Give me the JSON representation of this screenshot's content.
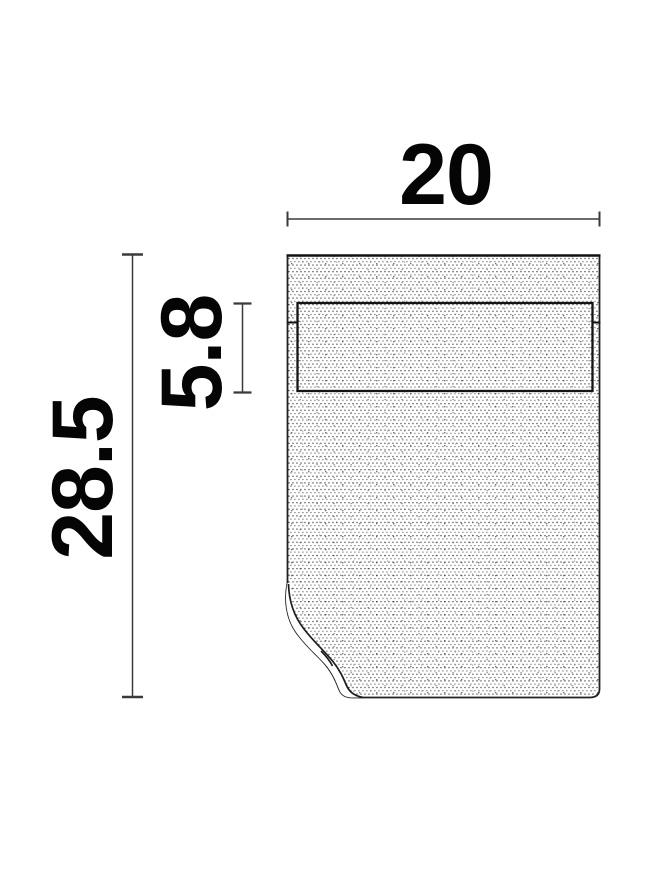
{
  "page": {
    "background": "#ffffff",
    "description": "Technical dimension drawing of a rectangular fabric shade with folded bottom-left corner"
  },
  "diagram": {
    "type": "product-dimension-drawing",
    "dimensions": {
      "width": "20",
      "height": "28.5",
      "inner_height": "5.8"
    },
    "colors": {
      "outline": "#1c1c1c",
      "inner_panel_line": "#141414",
      "dimension_line": "#3a3a3a",
      "label_text": "#050505",
      "stipple_dot": "#262626",
      "background": "#ffffff"
    }
  }
}
